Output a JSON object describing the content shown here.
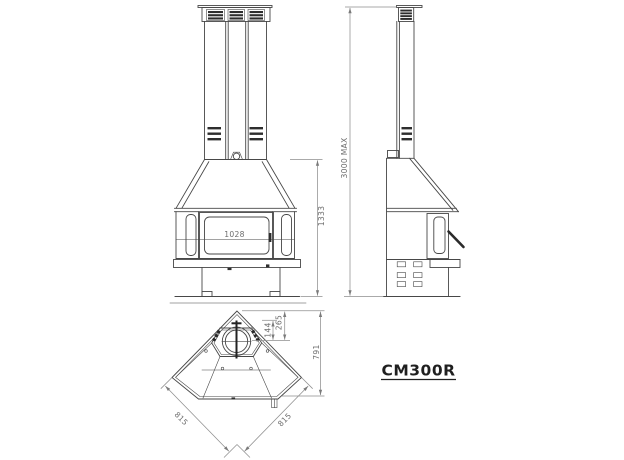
{
  "model": {
    "name": "CM300R"
  },
  "colors": {
    "line": "#474747",
    "dimension": "#8f8f8f",
    "dim_text": "#6d6d6d",
    "label_text": "#1f1f1f",
    "background": "#ffffff"
  },
  "dimensions": {
    "glass_width": {
      "value": "1028"
    },
    "body_height": {
      "value": "1333"
    },
    "max_height": {
      "value": "3000 MAX"
    },
    "plan_depth": {
      "value": "791"
    },
    "flue_offset_outer": {
      "value": "265"
    },
    "flue_offset_inner": {
      "value": "144"
    },
    "plan_side_left": {
      "value": "815"
    },
    "plan_side_right": {
      "value": "815"
    }
  }
}
